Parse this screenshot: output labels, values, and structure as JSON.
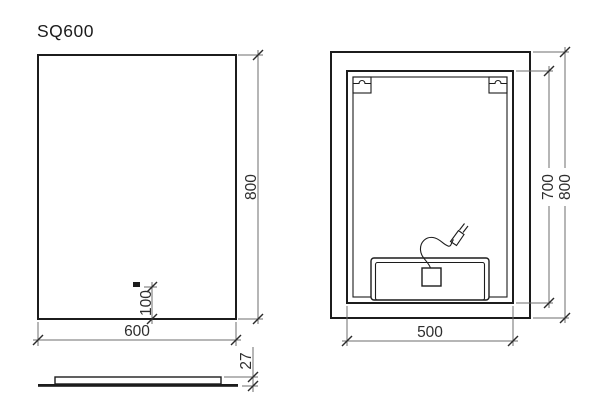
{
  "drawing": {
    "title": "SQ600",
    "views": {
      "front": {
        "width_mm": "600",
        "height_mm": "800",
        "cable_outlet_offset_mm": "100"
      },
      "side": {
        "thickness_mm": "27"
      },
      "back": {
        "hanging_zone_width_mm": "500",
        "hanging_zone_height_mm": "700",
        "height_mm": "800"
      }
    },
    "colors": {
      "background": "#ffffff",
      "outline": "#1c1c1c",
      "dimension_line": "#6e6e6e",
      "text": "#2e2e2e"
    }
  }
}
